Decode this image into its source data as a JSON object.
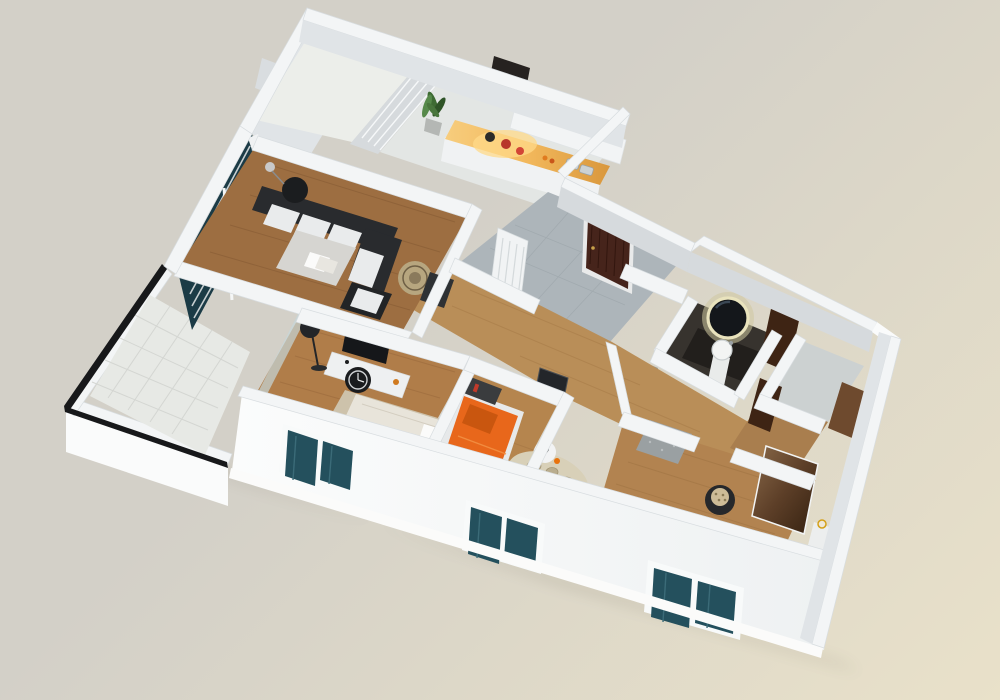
{
  "scene": {
    "description": "3D axonometric rendering of an apartment floor plan viewed from above, white walls cut open, on a beige background",
    "view": "isometric-top-down",
    "text_labels": "none visible"
  },
  "colors": {
    "bg_top": "#d3d0c8",
    "bg_bottom": "#e9e1c9",
    "wall_top": "#f3f5f6",
    "wall_bright": "#fafbfb",
    "wall_inner": "#e0e4e7",
    "wall_shade": "#d6dadd",
    "slab_shadow": "#5e594c",
    "wood_living": "#9d6e41",
    "wood_master": "#b07d49",
    "wood_kids": "#b5854e",
    "wood_corridor": "#b98e58",
    "wood_right": "#b28350",
    "tile_gray": "#adb5ba",
    "balcony_tile": "#e7e9e5",
    "bath_floor": "#37332e",
    "glass_teal": "#24505d",
    "glass_teal_dark": "#1b3b46",
    "orange": "#e8671b",
    "orange_dark": "#c9560f",
    "door_brown": "#46241b",
    "door_brown2": "#3e2414",
    "wardrobe_brown": "#6e4a2e",
    "sofa_dark": "#292b2e",
    "furn_dark": "#232528",
    "cushion": "#e9ebec",
    "counter_wood": "#e2a04a",
    "counter_glow": "#ffd98a",
    "rug_master": "#cdc2ab",
    "rug_kids": "#d8d0b8",
    "rail_black": "#17181a",
    "mirror_glow": "#e9e3bd",
    "bed_dark": "#26282b",
    "table_gray": "#d6d5d1",
    "plant_green": "#3e6b33",
    "white_soft": "#f0f2f3"
  },
  "rooms": [
    {
      "id": "utility-balcony",
      "floor": "white tile",
      "features": [
        "louvered-partition",
        "wall-fixture"
      ]
    },
    {
      "id": "kitchen",
      "floor": "light tile",
      "features": [
        "glowing-wood-counter",
        "cooktop-with-red-pots",
        "double-sink",
        "dark-range-hood",
        "upper-cabinets",
        "potted-plant"
      ]
    },
    {
      "id": "living-room",
      "floor": "dark wood planks",
      "features": [
        "dark-corner-sofa-white-cushions",
        "gray-coffee-table-with-magazines",
        "black-round-side-table",
        "table-lamp",
        "rattan-round-chair",
        "dark-side-table",
        "window-with-white-blinds",
        "curtain"
      ]
    },
    {
      "id": "entry-hall",
      "floor": "gray tile",
      "features": [
        "dark-walnut-front-door",
        "white-louvered-closet",
        "diamond-tiled-niche"
      ]
    },
    {
      "id": "master-bedroom",
      "floor": "wood planks",
      "features": [
        "white-bed-patterned-duvet",
        "swirl-rug",
        "white-tv-sideboard",
        "flat-tv",
        "black-wall-clock",
        "black-floor-lamp",
        "sliding-door-to-balcony"
      ]
    },
    {
      "id": "balcony",
      "floor": "white tile grid",
      "features": [
        "black-metal-railing",
        "white-parapet"
      ]
    },
    {
      "id": "kids-bedroom",
      "floor": "wood planks",
      "features": [
        "orange-bed",
        "dark-headboard-shelf",
        "dark-wall-art",
        "round-white-stool-table",
        "dark-desk-chair",
        "pebble-rug"
      ]
    },
    {
      "id": "corridor",
      "floor": "wood planks",
      "features": []
    },
    {
      "id": "bathroom",
      "floor": "dark tile",
      "features": [
        "round-backlit-mirror",
        "pedestal-sink",
        "dark-vanity",
        "wooden-door"
      ]
    },
    {
      "id": "storage-rooms",
      "floor": "wood",
      "features": [
        "wooden-doors",
        "empty-gray-room"
      ]
    },
    {
      "id": "bedroom-2",
      "floor": "wood planks",
      "features": [
        "dark-duvet-bed-white-pillows",
        "round-patterned-ottoman",
        "mirrored-wardrobe-panel",
        "nightstand-with-candle",
        "textured-closet-wall"
      ]
    }
  ],
  "exterior": {
    "windows": [
      {
        "room": "master-bedroom",
        "panes": 2,
        "glass": "dark teal"
      },
      {
        "room": "kids-bedroom",
        "panes": 2,
        "glass": "dark teal"
      },
      {
        "room": "bedroom-2",
        "panes": 2,
        "glass": "dark teal"
      },
      {
        "room": "living-room",
        "panes": 3,
        "glass": "dark teal with white blinds"
      }
    ],
    "front_door": "dark walnut paneled",
    "railing": "black metal on balcony parapet"
  }
}
